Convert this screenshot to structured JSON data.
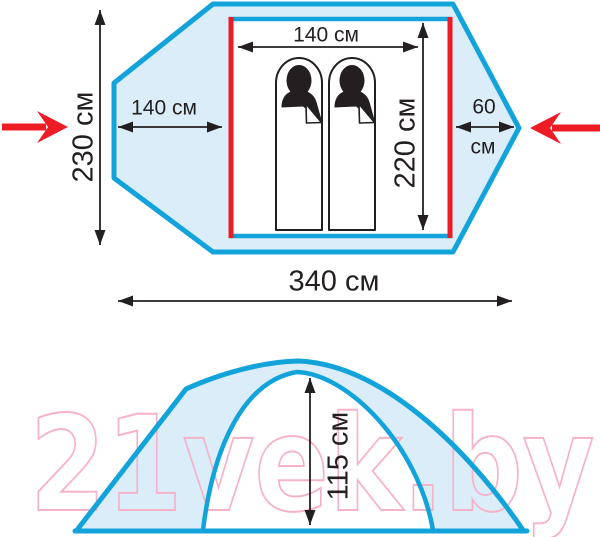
{
  "top_view": {
    "inner_width_label": "140 см",
    "inner_depth_label": "220 см",
    "left_vestibule_label": "140 см",
    "right_vestibule_value": "60",
    "right_vestibule_unit": "см",
    "outer_width_label": "230 см",
    "total_length_label": "340 см"
  },
  "side_view": {
    "height_label": "115 см"
  },
  "watermark": {
    "text": "21vek.by"
  },
  "colors": {
    "tent_outline": "#12a3db",
    "tent_fill": "#daedf9",
    "floor_edge_red": "#ed1c24",
    "entrance_arrow_red": "#ed1c24",
    "dimension_black": "#231f20",
    "watermark_pink": "#f6b3c8"
  }
}
